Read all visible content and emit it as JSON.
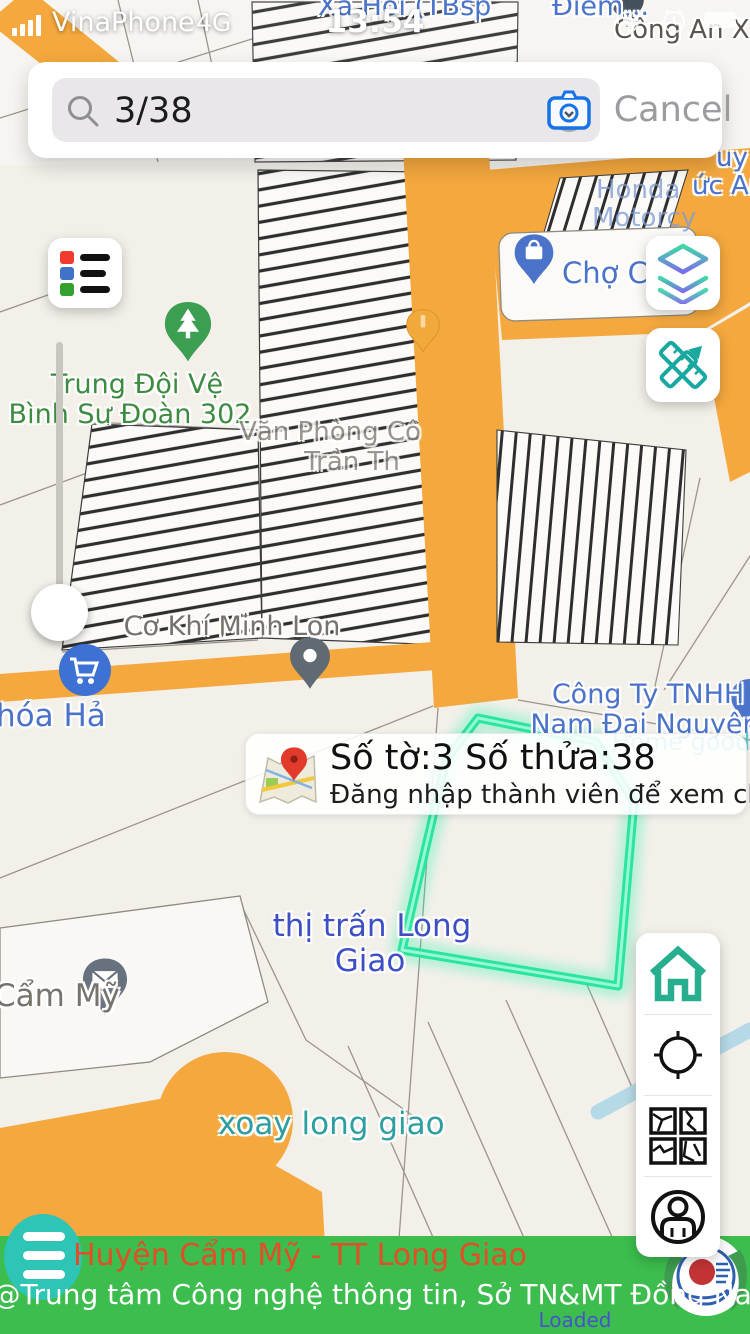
{
  "status_bar": {
    "carrier": "VinaPhone",
    "network": "4G",
    "time": "13:54"
  },
  "search": {
    "query": "3/38",
    "cancel_label": "Cancel"
  },
  "popup": {
    "title": "Số tờ:3 Số thửa:38",
    "subtitle": "Đăng nhập thành viên để xem chi tiết"
  },
  "map_labels": {
    "xa_hoi": "Xã Hội (TBsp",
    "diem": "Điểm...",
    "cong_an": "Công An Xã Lon",
    "uy": "uy",
    "uc_anh": "ức Anh",
    "honda_line1": "Honda",
    "honda_line2": "Motorcy",
    "cho_cam": "Chợ Cẩm",
    "trung_doi_line1": "Trung Đội Vệ",
    "trung_doi_line2": "Bình Sư Đoàn 302",
    "van_phong_line1": "Văn Phòng Cô",
    "van_phong_line2": "Trần Th",
    "co_khi": "Cơ Khí Minh Lon",
    "cong_ty_line1": "Công Ty TNHH",
    "cong_ty_line2": "Nam Đại Nguyên",
    "home_goods": "Home goods store",
    "thi_tran_line1": "thị trấn Long",
    "thi_tran_line2": "Giao",
    "cam_my": "Cẩm Mỹ",
    "hoa_hai": "hóa Hả",
    "xoay": "xoay long giao"
  },
  "footer": {
    "region_title": "Huyện Cẩm Mỹ - TT Long Giao",
    "credit": "@Trung tâm Công nghệ thông tin, Sở TN&MT Đồng Nai",
    "status": "Loaded"
  },
  "colors": {
    "road_orange": "#F4A83E",
    "footer_green": "#3CBD4D",
    "accent_teal": "#2EC4B6",
    "highlight_teal": "#23E49C",
    "title_red": "#E44D26",
    "label_blue": "#4A73C9"
  }
}
